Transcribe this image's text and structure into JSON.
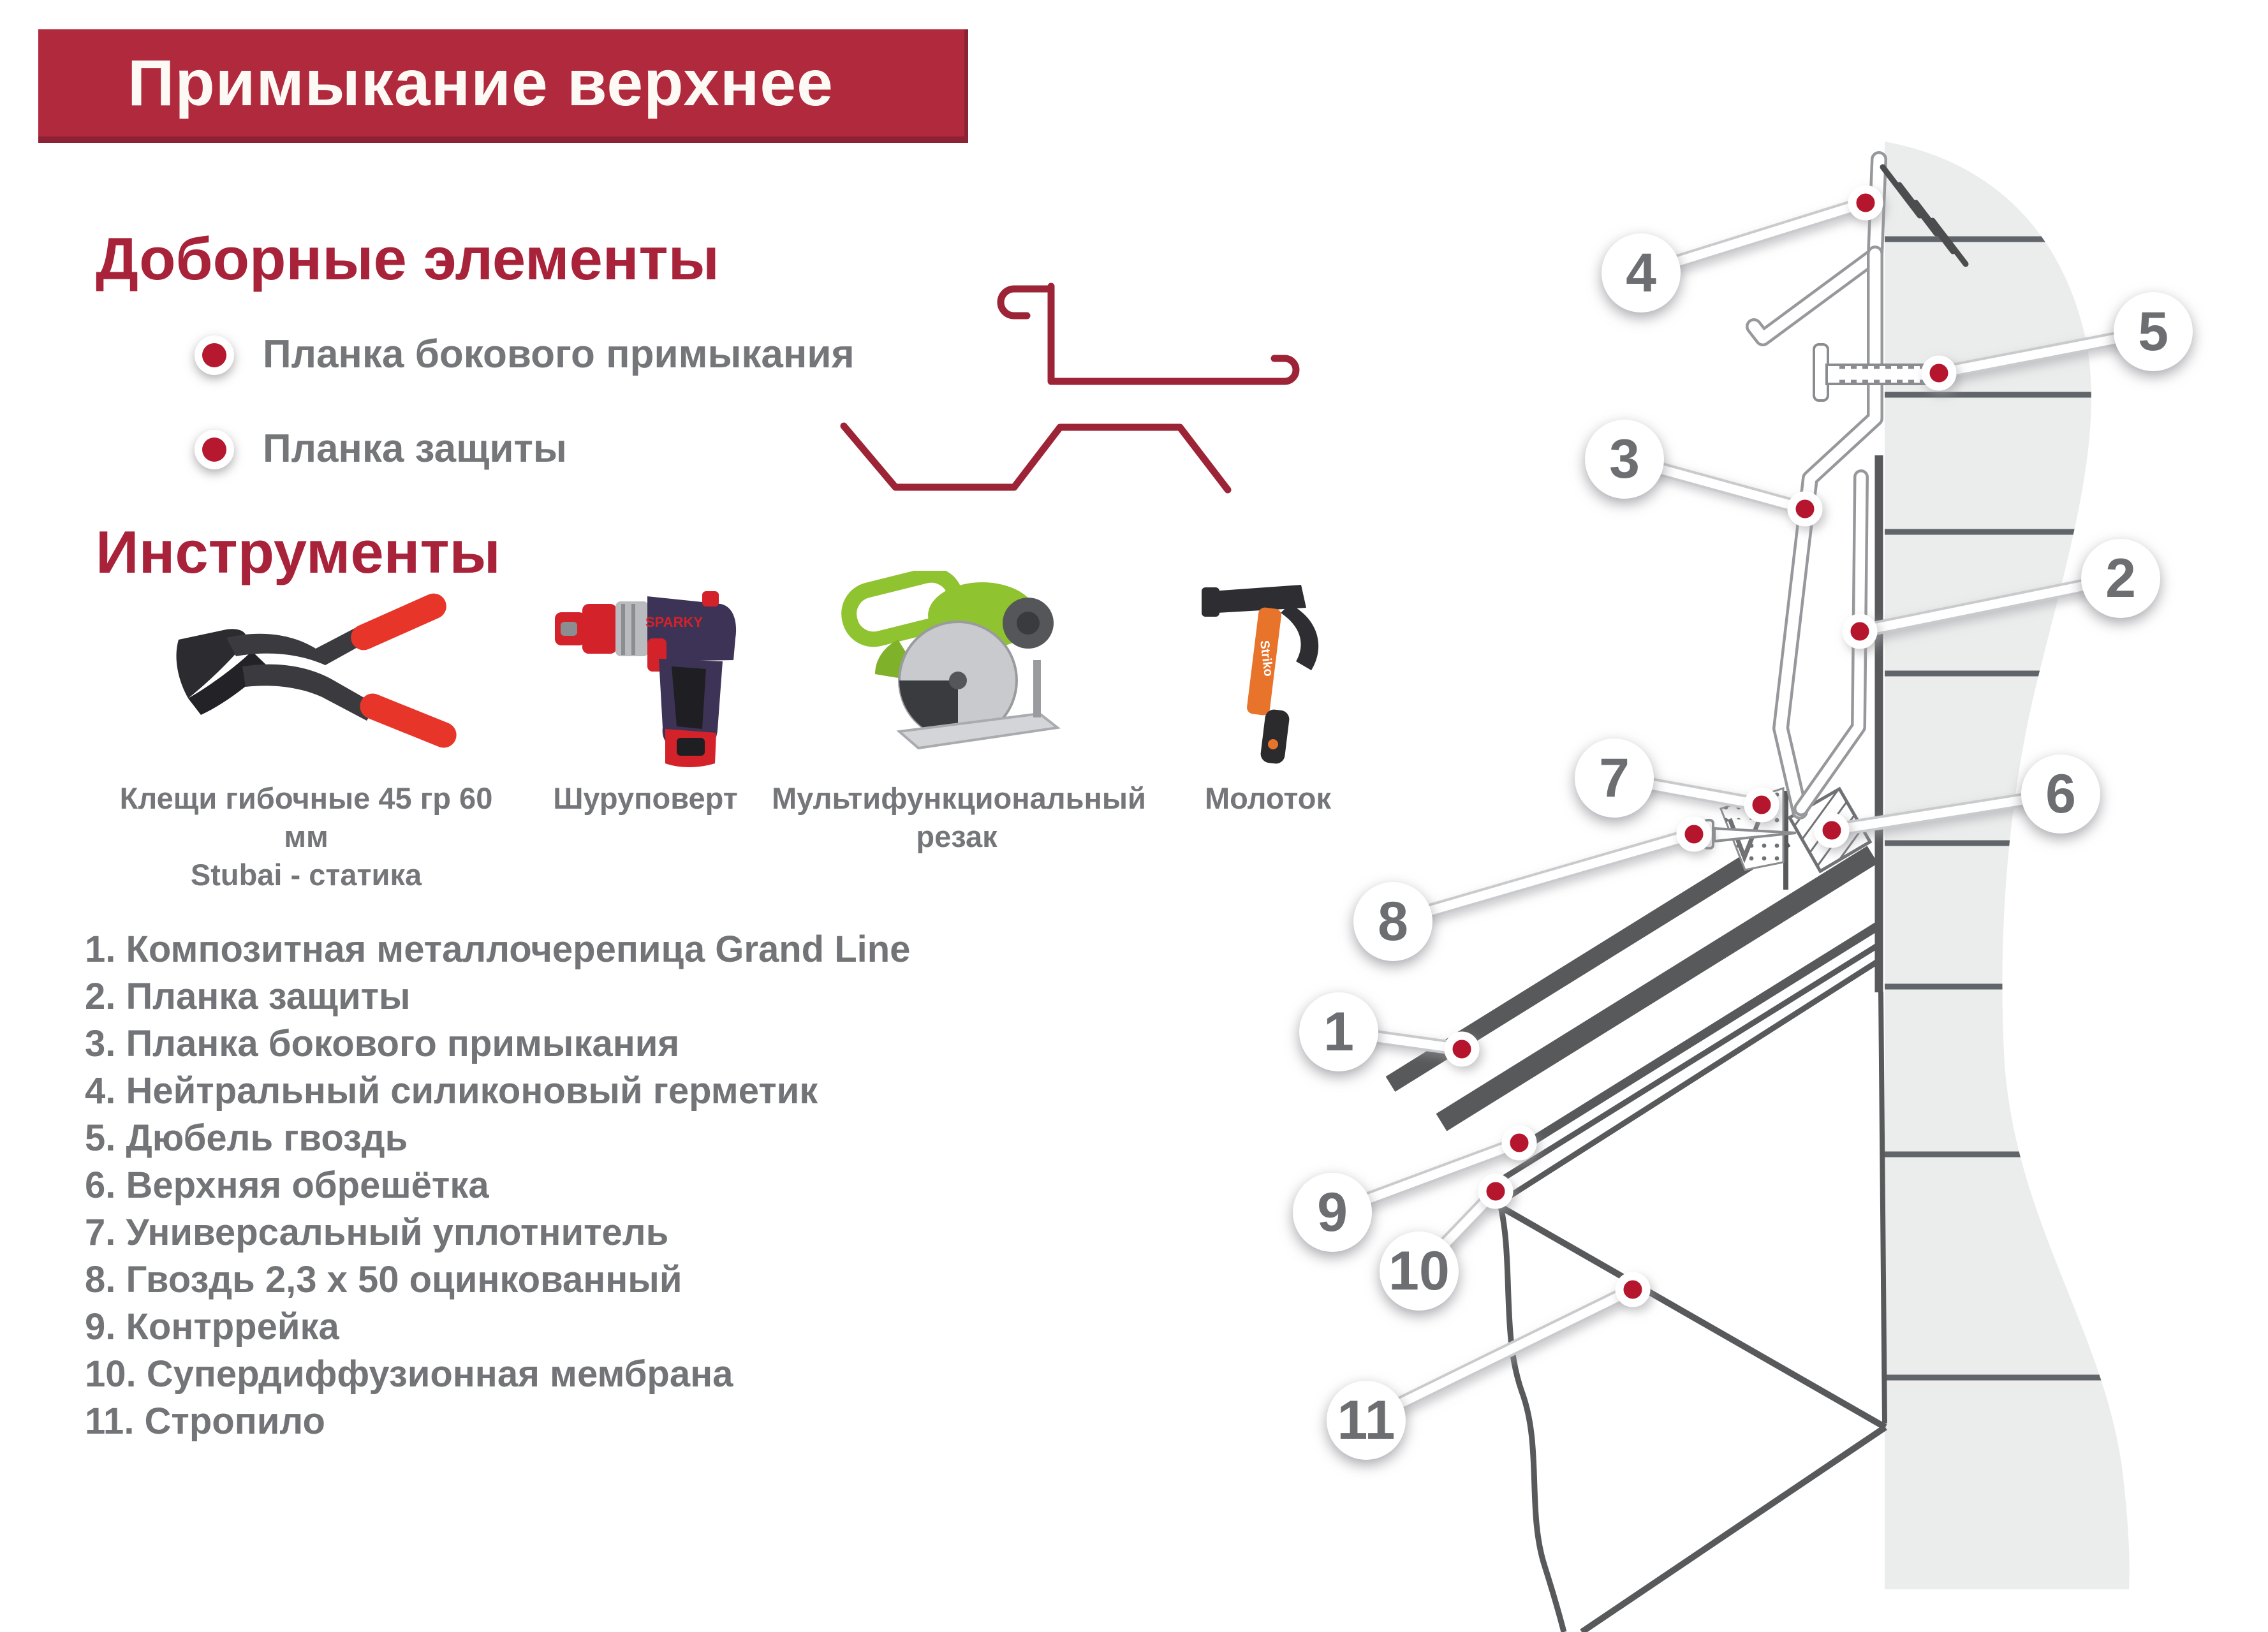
{
  "title": "Примыкание верхнее",
  "colors": {
    "banner_red": "#b0293c",
    "heading_red": "#a8233a",
    "text_gray": "#75767a",
    "marker_red": "#b5182f",
    "wall_gray": "#ebecec",
    "line_dark": "#58595b",
    "profile_red": "#9d2336"
  },
  "sections": {
    "additional": {
      "heading": "Доборные элементы",
      "items": [
        {
          "label": "Планка бокового примыкания",
          "icon": "side-abutment-flashing-profile"
        },
        {
          "label": "Планка защиты",
          "icon": "protection-flashing-profile"
        }
      ]
    },
    "tools": {
      "heading": "Инструменты",
      "items": [
        {
          "caption": "Клещи гибочные 45 гр 60 мм\nStubai - статика",
          "icon": "bending-pliers"
        },
        {
          "caption": "Шуруповерт",
          "icon": "cordless-screwdriver",
          "brand_label": "SPARKY"
        },
        {
          "caption": "Мультифункциональный\nрезак",
          "icon": "multifunction-cutter"
        },
        {
          "caption": "Молоток",
          "icon": "hammer",
          "brand_label": "Striko"
        }
      ]
    }
  },
  "legend": {
    "items": [
      {
        "text": "1. Композитная металлочерепица Grand Line"
      },
      {
        "text": "2. Планка защиты"
      },
      {
        "text": "3. Планка бокового примыкания"
      },
      {
        "text": "4. Нейтральный силиконовый герметик"
      },
      {
        "text": "5. Дюбель гвоздь"
      },
      {
        "text": "6. Верхняя обрешётка"
      },
      {
        "text": "7. Универсальный уплотнитель"
      },
      {
        "text": "8. Гвоздь 2,3 х 50 оцинкованный"
      },
      {
        "text": "9. Контррейка"
      },
      {
        "text": "10. Супердиффузионная мембрана"
      },
      {
        "text": "11. Стропило"
      }
    ]
  },
  "diagram": {
    "callouts": [
      {
        "n": "4"
      },
      {
        "n": "5"
      },
      {
        "n": "3"
      },
      {
        "n": "2"
      },
      {
        "n": "7"
      },
      {
        "n": "6"
      },
      {
        "n": "8"
      },
      {
        "n": "1"
      },
      {
        "n": "9"
      },
      {
        "n": "10"
      },
      {
        "n": "11"
      }
    ]
  }
}
